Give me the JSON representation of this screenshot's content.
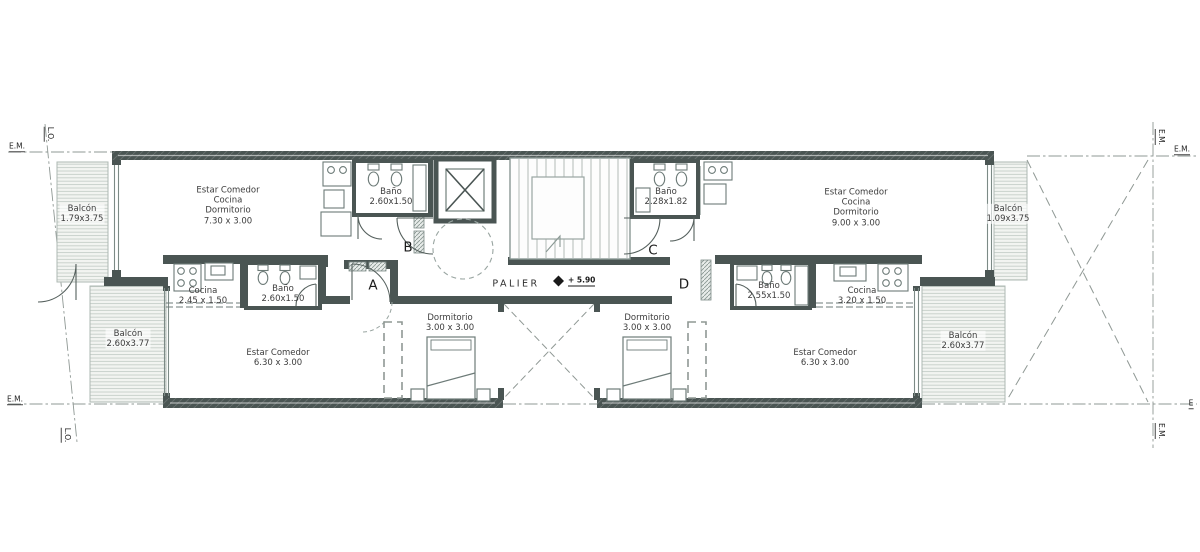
{
  "site_labels": {
    "top_left_em": "E.M.",
    "top_left_lo": "L.O.",
    "top_right_em_vertical": "E.M.",
    "top_right_em": "E.M.",
    "bottom_left_em": "E.M.",
    "bottom_left_lo": "L.O.",
    "bottom_right_e": "E",
    "bottom_right_em_vertical": "E.M."
  },
  "core": {
    "palier_label": "PALIER",
    "level_mark": "+ 5.90"
  },
  "door_tags": {
    "a": "A",
    "b": "B",
    "c": "C",
    "d": "D"
  },
  "rooms": {
    "unit_top_left": {
      "lines": [
        "Estar Comedor",
        "Cocina",
        "Dormitorio",
        "7.30 x 3.00"
      ]
    },
    "bath_top_left": {
      "lines": [
        "Baño",
        "2.60x1.50"
      ]
    },
    "bath_top_right": {
      "lines": [
        "Baño",
        "2.28x1.82"
      ]
    },
    "unit_top_right": {
      "lines": [
        "Estar Comedor",
        "Cocina",
        "Dormitorio",
        "9.00 x 3.00"
      ]
    },
    "balcony_upper_left": {
      "lines": [
        "Balcón",
        "1.79x3.75"
      ]
    },
    "balcony_upper_right": {
      "lines": [
        "Balcón",
        "1.09x3.75"
      ]
    },
    "kitchen_left": {
      "lines": [
        "Cocina",
        "2.45 x 1.50"
      ]
    },
    "bath_mid_left": {
      "lines": [
        "Baño",
        "2.60x1.50"
      ]
    },
    "bath_mid_right": {
      "lines": [
        "Baño",
        "2.55x1.50"
      ]
    },
    "kitchen_right": {
      "lines": [
        "Cocina",
        "3.20 x 1.50"
      ]
    },
    "dorm_left": {
      "lines": [
        "Dormitorio",
        "3.00 x 3.00"
      ]
    },
    "dorm_right": {
      "lines": [
        "Dormitorio",
        "3.00 x 3.00"
      ]
    },
    "living_left": {
      "lines": [
        "Estar Comedor",
        "6.30 x 3.00"
      ]
    },
    "living_right": {
      "lines": [
        "Estar Comedor",
        "6.30 x 3.00"
      ]
    },
    "balcony_lower_left": {
      "lines": [
        "Balcón",
        "2.60x3.77"
      ]
    },
    "balcony_lower_right": {
      "lines": [
        "Balcón",
        "2.60x3.77"
      ]
    }
  },
  "colors": {
    "wall": "#4a5553",
    "thin_line": "#7c8a86",
    "dashed_line": "#8f9894",
    "balcony_fill": "#f2f4f1",
    "balcony_hatch": "#c6cec9",
    "text": "#3c3c3c"
  }
}
